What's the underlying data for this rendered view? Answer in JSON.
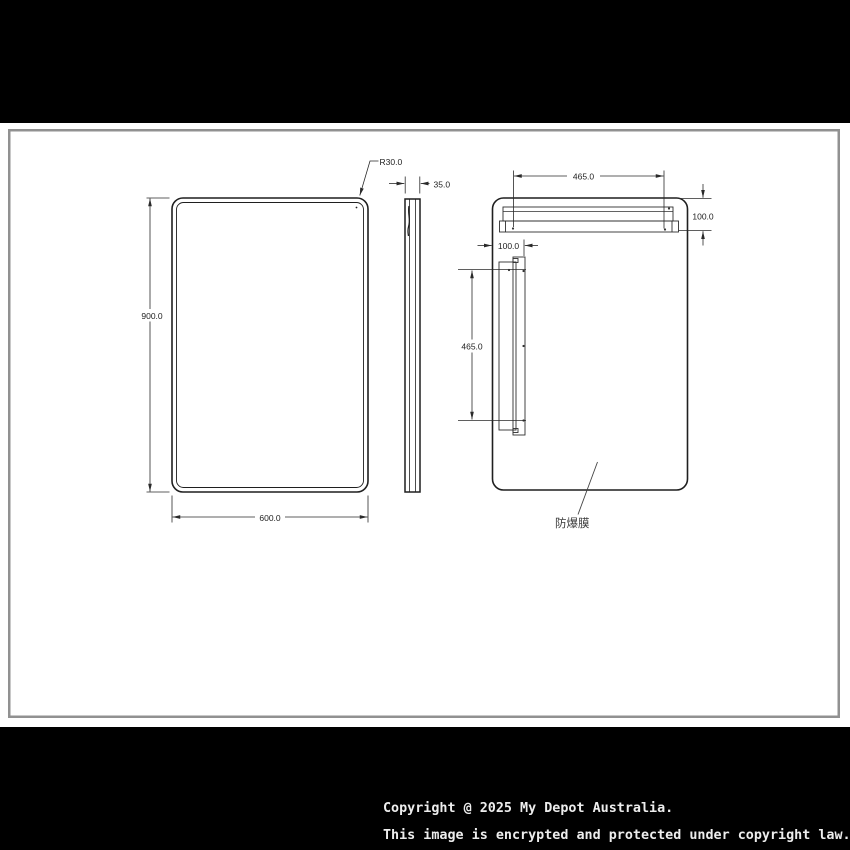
{
  "colors": {
    "background": "#000000",
    "sheet": "#ffffff",
    "sheet_border": "#919191",
    "outline": "#1f1f1f",
    "dimension": "#2a2a2a",
    "footer_text": "#ededed"
  },
  "drawing": {
    "front": {
      "height_dim": "900.0",
      "width_dim": "600.0",
      "corner_radius_dim": "R30.0"
    },
    "side": {
      "depth_dim": "35.0"
    },
    "back": {
      "bracket_width_dim": "465.0",
      "bracket_height_dim": "465.0",
      "top_offset_dim": "100.0",
      "left_offset_dim": "100.0",
      "film_label": "防爆膜"
    }
  },
  "footer": {
    "line1": "Copyright @ 2025 My Depot Australia.",
    "line2": "This image is encrypted and protected under copyright law."
  }
}
